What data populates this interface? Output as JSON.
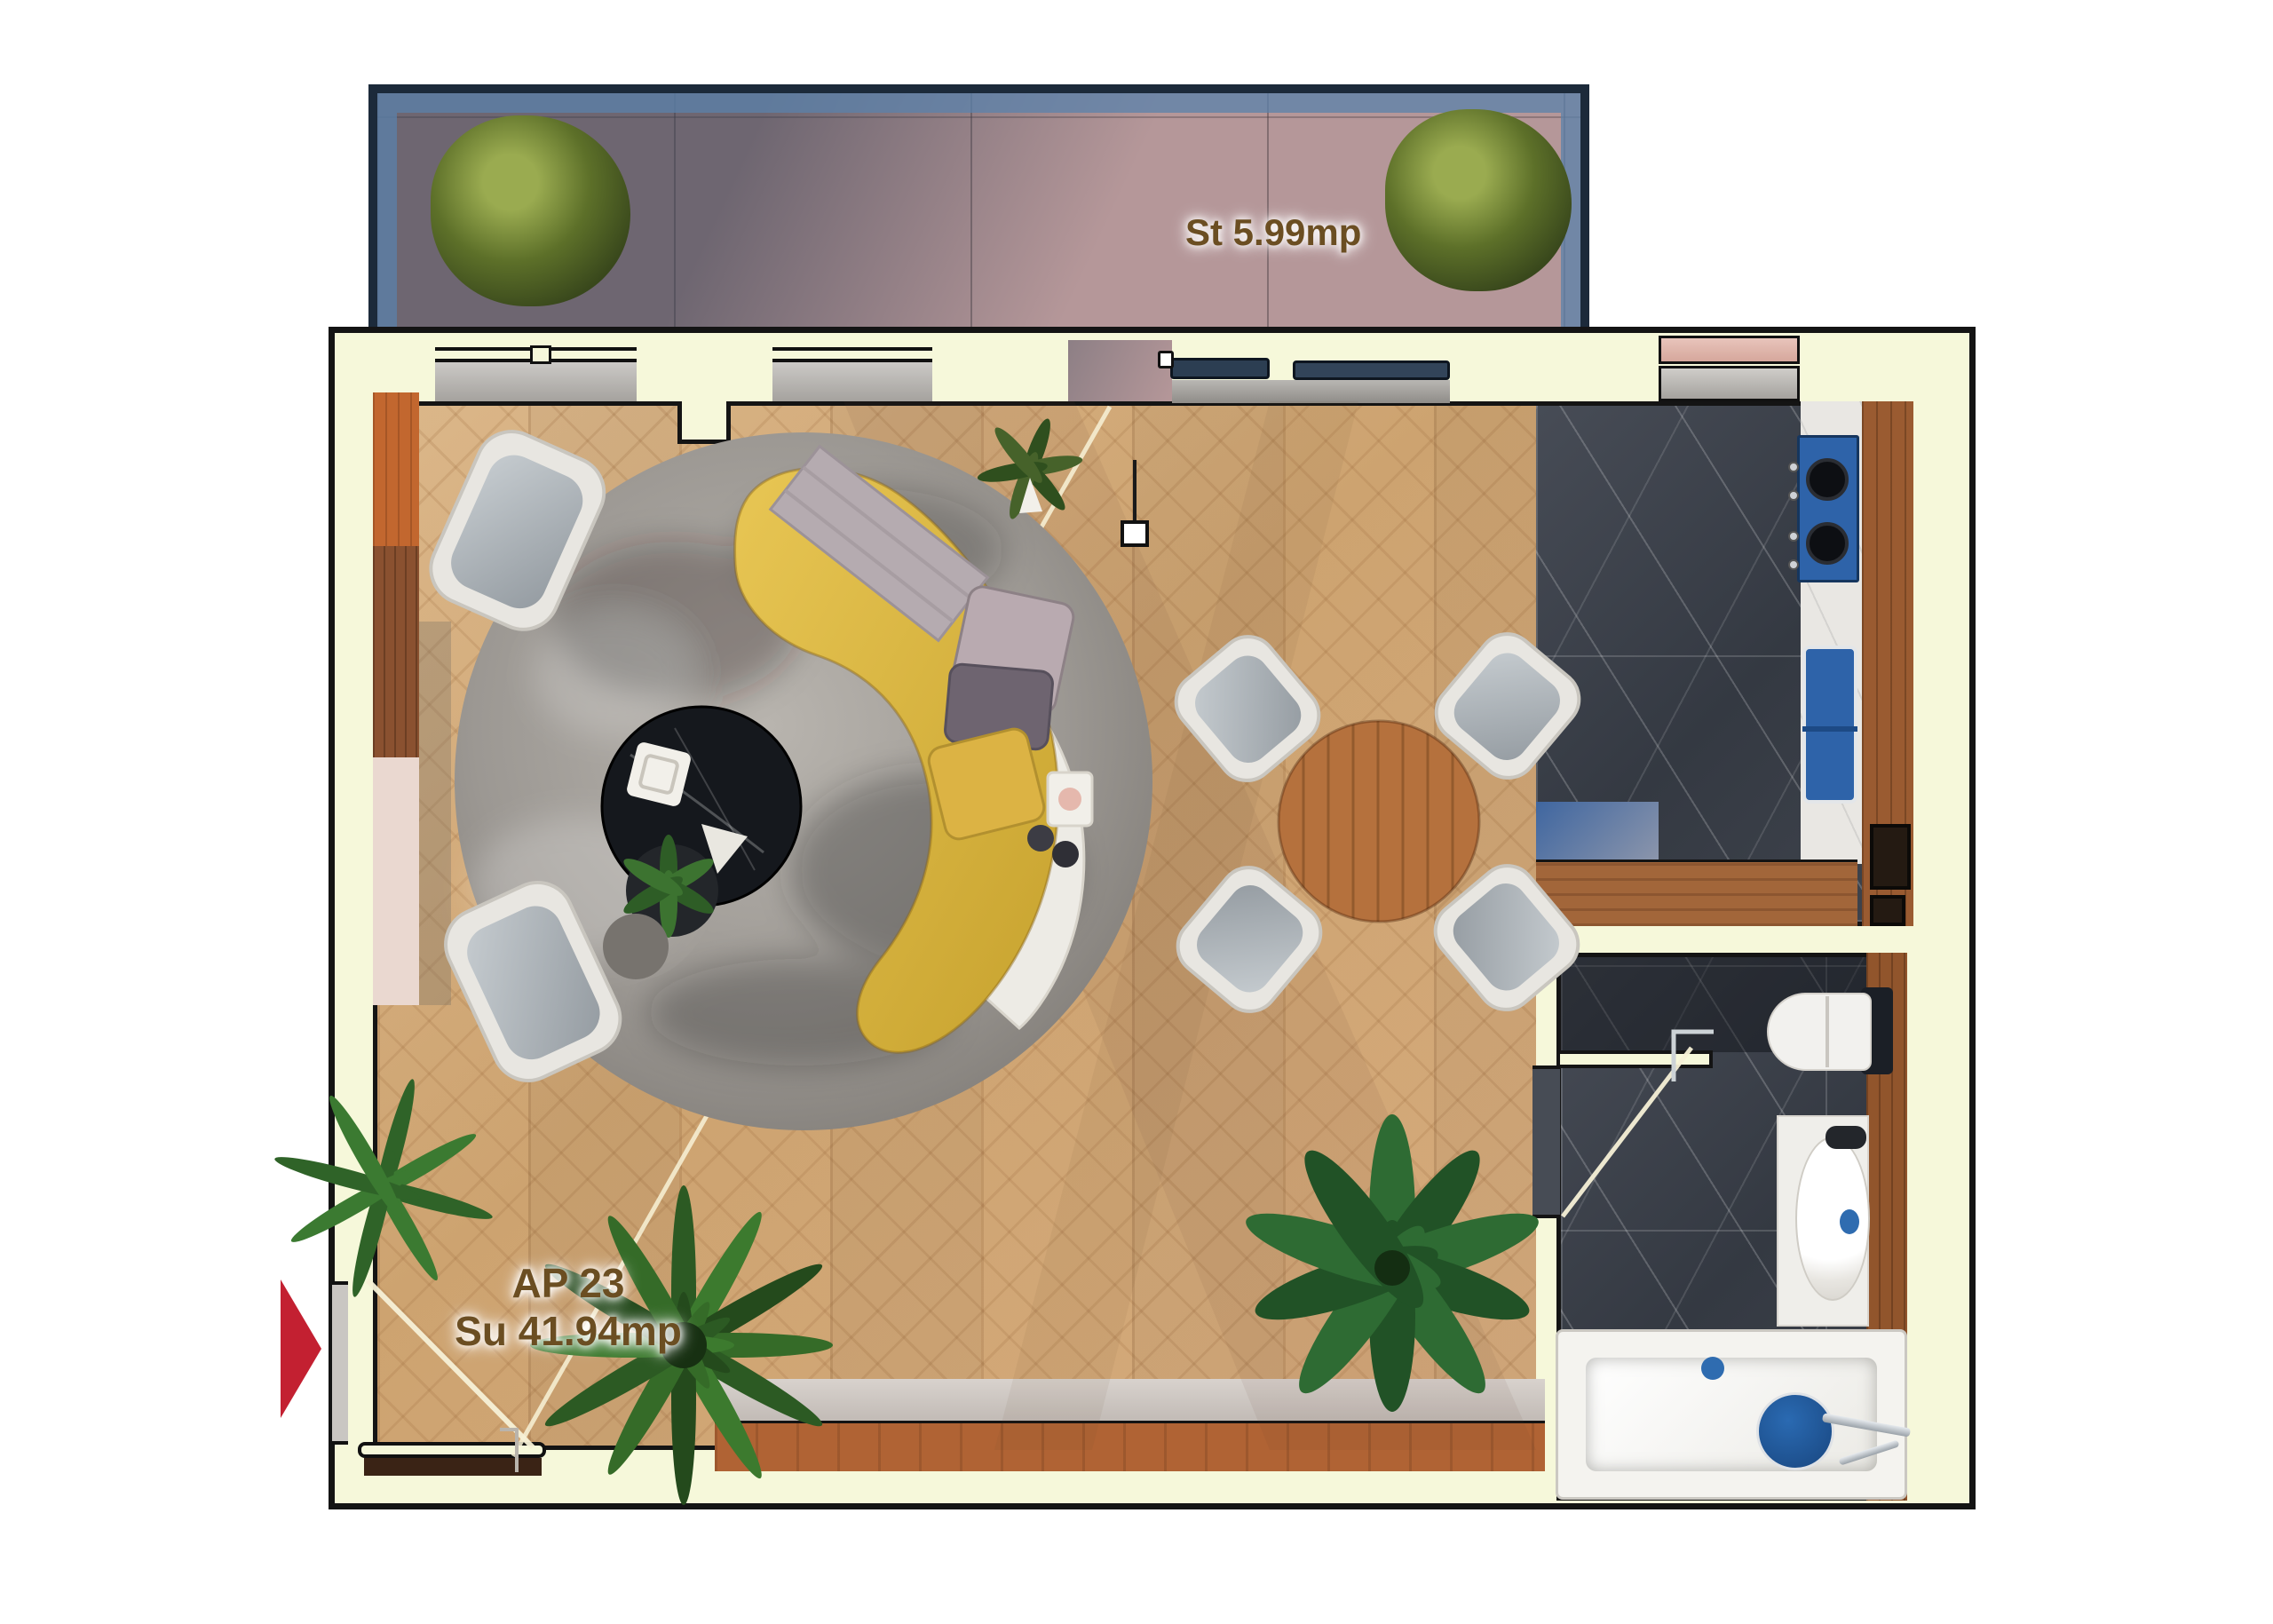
{
  "plan": {
    "terrace_label": "St 5.99mp",
    "apartment_label": "AP 23",
    "apartment_area_label": "Su 41.94mp"
  },
  "colors": {
    "wall-fill": "#f6f8da",
    "wall-stroke": "#141414",
    "wood-floor": "#d9b386",
    "marble-floor": "#3e434c",
    "terrace-tile": "#b59799",
    "railing-frame": "#1c2a3a",
    "railing-glass": "#5b82ab",
    "door-navy": "#2c3e52",
    "sofa-yellow": "#d7b23e",
    "rug-gray": "#a39e99",
    "chair-frame": "#e8e6e1",
    "chair-seat": "#a7aeb4",
    "dining-wood": "#b5713d",
    "cabinet-orange": "#c2672f",
    "cabinet-brown": "#8a5130",
    "sideboard-wood": "#b06334",
    "counter-white": "#e9e7e3",
    "appliance-blue": "#2e63a9",
    "fixture-white": "#f2f1ee",
    "plant-green": "#2e5d26",
    "arrow-red": "#c32031",
    "label-brown": "#6b4e22"
  }
}
